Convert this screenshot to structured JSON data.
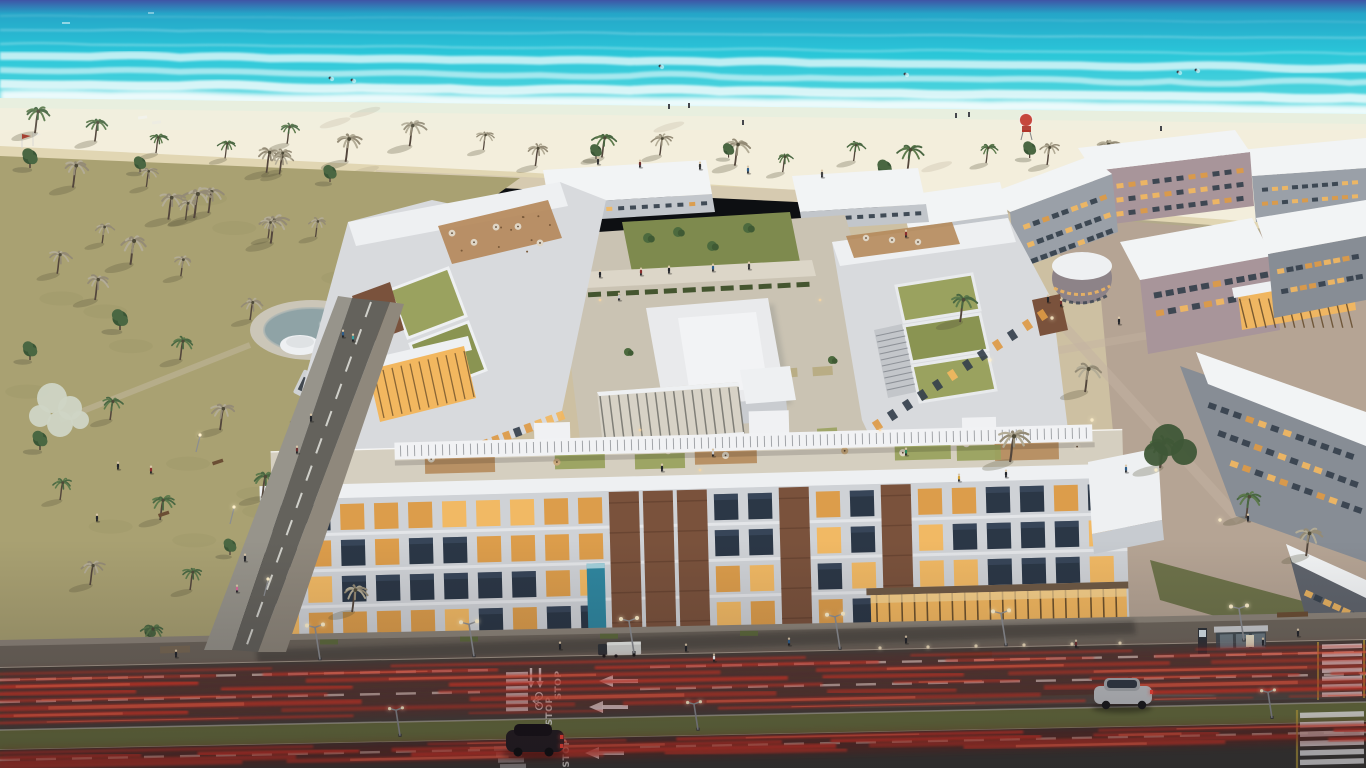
{
  "scene": {
    "title": "Aerial dusk rendering of a beachfront residential complex with palm park, turquoise sea and a boulevard with tail-light trails",
    "time_of_day": "dusk",
    "road_markings": {
      "stop_text": "STOP",
      "lane_arrow_direction": "left",
      "bike_lane": "bicycle-symbol"
    },
    "objects": {
      "ocean": "turquoise sea with breaking surf and swimmers",
      "beach": "white sand beach with palms, loungers, flags and a red lifeguard post",
      "main_complex": "U-shaped apartment complex with brick accents, lit windows, rooftop lawns and terrace cafes",
      "courtyard": "landscaped inner courtyard with pavilion, pergola and pool",
      "right_district": "neighbouring blocks with white roofs, mauve and grey facades, lit window strips",
      "park": "palm park with lawns and paths",
      "boulevard": "dual carriageway with STOP markings, left arrows, bike lane, crosswalks and red light trails",
      "vehicles": [
        "silver suv",
        "dark suv",
        "parked truck",
        "white van"
      ],
      "street_furniture": [
        "street lamps",
        "bus shelter",
        "benches",
        "sign totem"
      ]
    },
    "counts": {
      "beach_palms": 22,
      "park_palms": 16,
      "park_pines": 9,
      "rooftop_umbrellas": 12,
      "light_trails_near": 8,
      "light_trails_far": 4,
      "lamps_main_road": 6
    },
    "palette": {
      "sea_deep": "#3348a0",
      "ocean_top": "#179fc4",
      "ocean_mid": "#1cc2d6",
      "ocean_low": "#55d8de",
      "foam": "#ffffff",
      "wet_sand": "#e9eedd",
      "sand_light": "#f3eedc",
      "sand_deep": "#dcd0a9",
      "seaweed": "#8a7a58",
      "park_grass": "#a9a172",
      "park_shadow": "#6f6c4a",
      "pine": "#4a6742",
      "pine_dark": "#3a5636",
      "palm_dusty": "#948b76",
      "palm_pale": "#b3ac96",
      "trunk": "#53463c",
      "blossom": "#cfd5c5",
      "bldg_white": "#eef0f2",
      "bldg_light": "#d8dadd",
      "bldg_mid": "#c2c6cb",
      "bldg_shade": "#9fa4ab",
      "brick": "#7a523c",
      "brick_dark": "#5e3d2c",
      "win_dark": "#243040",
      "win_lit": "#f2b75f",
      "win_lit2": "#dd9a45",
      "green_roof": "#9aa25f",
      "green_roof2": "#8a9452",
      "deck": "#b5895b",
      "courtyard": "#cac3b3",
      "path_light": "#dcd6c8",
      "hedge": "#44552f",
      "lawn": "#7e8a4e",
      "mauve": "#a8959a",
      "mauve_deep": "#8d8388",
      "gray_fac": "#9aa0a8",
      "gray_deep": "#878d95",
      "dark_fac": "#5f646c",
      "district_ground": "#b5a494",
      "sidewalk": "#6e665c",
      "sidewalk_light": "#8d857a",
      "asphalt": "#45443f",
      "asphalt2": "#3b3a36",
      "median": "#6b7240",
      "curb": "#b3ac9e",
      "lane_line": "#e3e4de",
      "teal_lane": "#4e7a72",
      "trail": "#e63a2c",
      "trail_deep": "#8f1c16",
      "trail_bright": "#ff6f52",
      "lamp_glow": "#fff1cc",
      "pool": "#2f87a0",
      "pond": "#8fa3a6",
      "crosswalk_yellow": "#c9ae3e",
      "night_shade_rgb": "20,16,24"
    }
  }
}
